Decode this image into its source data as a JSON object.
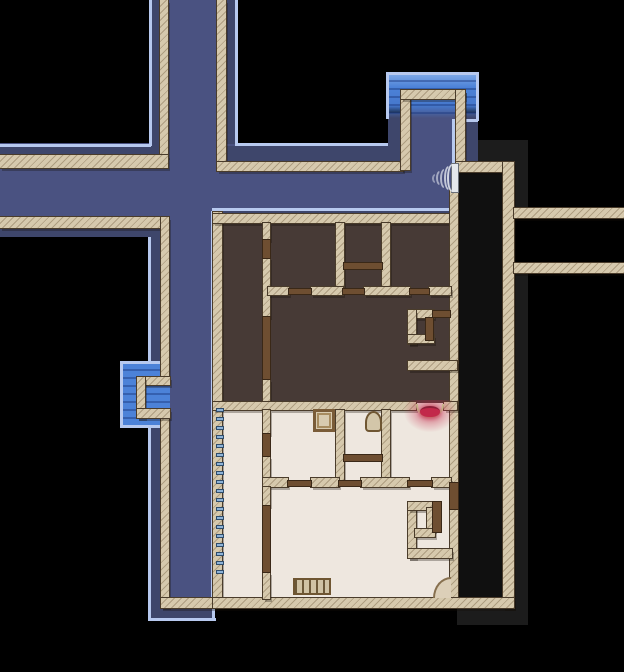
{
  "app": {
    "name": "top-down-map-view",
    "view": "explored floor plan with streets, water and building interior"
  },
  "canvas": {
    "w": 624,
    "h": 672
  },
  "palette": {
    "street": "#4a5281",
    "street_shadow": "#3e466b",
    "visibility_line": "#b7c9ef",
    "water": "#4c82d8",
    "wall": "#d6c9ad",
    "wall_hatch": "rgba(140,122,92,0.55)",
    "wall_edge": "#4a3c2b",
    "door_wood": "#6e4e31",
    "dark_room_floor": "#473a36",
    "light_room_floor": "#eee7df",
    "fog_gray": "#1c1c1c",
    "void_room": "#101010",
    "alert_red": "#c2294a",
    "window_tick": "#8db3d8"
  },
  "layers": [
    {
      "name": "fog-gray-patch",
      "cls": "g",
      "items": [
        [
          478,
          140,
          50,
          22
        ],
        [
          514,
          162,
          14,
          46
        ],
        [
          514,
          273,
          14,
          334
        ],
        [
          457,
          607,
          71,
          18
        ]
      ]
    },
    {
      "name": "unlit-room",
      "cls": "vd",
      "items": [
        [
          458,
          170,
          45,
          429
        ]
      ]
    },
    {
      "name": "street-floor",
      "cls": "st",
      "items": [
        [
          149,
          0,
          88,
          170
        ],
        [
          0,
          143,
          457,
          94
        ],
        [
          148,
          237,
          66,
          384
        ],
        [
          401,
          88,
          64,
          82
        ]
      ]
    },
    {
      "name": "street-shadow",
      "cls": "sh",
      "items": [
        [
          151,
          0,
          9,
          148
        ],
        [
          226,
          0,
          9,
          144
        ],
        [
          0,
          146,
          160,
          9
        ],
        [
          0,
          228,
          163,
          9
        ],
        [
          226,
          146,
          175,
          16
        ],
        [
          214,
          210,
          243,
          7
        ],
        [
          150,
          237,
          10,
          125
        ],
        [
          150,
          427,
          10,
          180
        ],
        [
          150,
          607,
          63,
          13
        ],
        [
          388,
          113,
          13,
          49
        ],
        [
          465,
          113,
          13,
          49
        ]
      ]
    },
    {
      "name": "water-pool",
      "cls": "wa",
      "items": [
        [
          386,
          74,
          92,
          44
        ]
      ]
    },
    {
      "name": "water-pool-side",
      "cls": "wa2",
      "items": [
        [
          122,
          363,
          48,
          63
        ]
      ]
    },
    {
      "name": "dark-room-floor",
      "cls": "fd",
      "items": [
        [
          221,
          222,
          230,
          181
        ]
      ]
    },
    {
      "name": "light-room-floor",
      "cls": "fl",
      "items": [
        [
          221,
          403,
          230,
          196
        ]
      ]
    },
    {
      "name": "visibility-line",
      "cls": "ll",
      "items": [
        [
          149,
          0,
          3,
          146
        ],
        [
          0,
          144,
          151,
          3
        ],
        [
          235,
          0,
          3,
          144
        ],
        [
          235,
          143,
          153,
          3
        ],
        [
          212,
          208,
          242,
          3
        ],
        [
          211,
          211,
          3,
          396
        ],
        [
          148,
          237,
          3,
          126
        ],
        [
          148,
          427,
          3,
          194
        ],
        [
          148,
          618,
          68,
          3
        ],
        [
          212,
          607,
          3,
          14
        ],
        [
          386,
          72,
          93,
          3
        ],
        [
          386,
          72,
          3,
          47
        ],
        [
          476,
          72,
          3,
          49
        ],
        [
          452,
          119,
          26,
          3
        ],
        [
          452,
          121,
          3,
          47
        ],
        [
          120,
          361,
          3,
          67
        ],
        [
          120,
          361,
          44,
          3
        ],
        [
          120,
          425,
          44,
          3
        ]
      ]
    },
    {
      "name": "wall-segment",
      "cls": "w",
      "items": [
        [
          160,
          0,
          8,
          157
        ],
        [
          0,
          155,
          168,
          13
        ],
        [
          217,
          0,
          9,
          164
        ],
        [
          217,
          162,
          186,
          9
        ],
        [
          0,
          217,
          163,
          11
        ],
        [
          161,
          217,
          8,
          162
        ],
        [
          161,
          415,
          8,
          192
        ],
        [
          137,
          377,
          33,
          8
        ],
        [
          137,
          377,
          8,
          41
        ],
        [
          137,
          409,
          33,
          9
        ],
        [
          161,
          598,
          56,
          10
        ],
        [
          401,
          90,
          9,
          80
        ],
        [
          401,
          90,
          64,
          9
        ],
        [
          456,
          90,
          9,
          74
        ],
        [
          456,
          162,
          48,
          10
        ],
        [
          503,
          162,
          11,
          446
        ],
        [
          514,
          208,
          110,
          10
        ],
        [
          514,
          263,
          110,
          10
        ],
        [
          213,
          212,
          9,
          395
        ],
        [
          213,
          214,
          245,
          9
        ],
        [
          450,
          190,
          8,
          293
        ],
        [
          450,
          509,
          8,
          90
        ],
        [
          213,
          598,
          301,
          10
        ],
        [
          263,
          223,
          7,
          17
        ],
        [
          263,
          257,
          7,
          60
        ],
        [
          263,
          379,
          7,
          24
        ],
        [
          336,
          223,
          8,
          66
        ],
        [
          382,
          223,
          8,
          66
        ],
        [
          268,
          287,
          21,
          8
        ],
        [
          311,
          287,
          32,
          8
        ],
        [
          364,
          287,
          46,
          8
        ],
        [
          429,
          287,
          22,
          8
        ],
        [
          408,
          310,
          26,
          8
        ],
        [
          408,
          310,
          8,
          34
        ],
        [
          408,
          335,
          26,
          8
        ],
        [
          408,
          361,
          49,
          9
        ],
        [
          213,
          402,
          203,
          8
        ],
        [
          444,
          402,
          13,
          8
        ],
        [
          263,
          410,
          7,
          24
        ],
        [
          263,
          456,
          7,
          31
        ],
        [
          336,
          410,
          8,
          73
        ],
        [
          382,
          410,
          8,
          73
        ],
        [
          263,
          478,
          25,
          9
        ],
        [
          311,
          478,
          28,
          9
        ],
        [
          361,
          478,
          48,
          9
        ],
        [
          432,
          478,
          19,
          9
        ],
        [
          263,
          487,
          7,
          19
        ],
        [
          263,
          572,
          7,
          27
        ],
        [
          408,
          502,
          8,
          56
        ],
        [
          408,
          502,
          26,
          8
        ],
        [
          427,
          508,
          8,
          23
        ],
        [
          415,
          529,
          20,
          8
        ],
        [
          408,
          549,
          44,
          9
        ]
      ]
    },
    {
      "name": "door-wood",
      "cls": "dr",
      "items": [
        [
          263,
          240,
          7,
          18
        ],
        [
          263,
          317,
          7,
          62
        ],
        [
          344,
          263,
          38,
          6
        ],
        [
          289,
          289,
          22,
          5
        ],
        [
          343,
          289,
          21,
          5
        ],
        [
          410,
          289,
          19,
          5
        ],
        [
          433,
          311,
          17,
          6
        ],
        [
          426,
          318,
          7,
          22
        ],
        [
          263,
          434,
          7,
          22
        ],
        [
          344,
          455,
          38,
          6
        ],
        [
          288,
          481,
          23,
          5
        ],
        [
          339,
          481,
          22,
          5
        ],
        [
          408,
          481,
          24,
          5
        ],
        [
          450,
          483,
          8,
          26
        ],
        [
          263,
          506,
          7,
          66
        ],
        [
          433,
          502,
          8,
          30
        ]
      ]
    },
    {
      "name": "window-tick",
      "cls": "tk",
      "items": [
        [
          216,
          408,
          8,
          4
        ],
        [
          216,
          417,
          8,
          4
        ],
        [
          216,
          426,
          8,
          4
        ],
        [
          216,
          435,
          8,
          4
        ],
        [
          216,
          444,
          8,
          4
        ],
        [
          216,
          453,
          8,
          4
        ],
        [
          216,
          462,
          8,
          4
        ],
        [
          216,
          471,
          8,
          4
        ],
        [
          216,
          480,
          8,
          4
        ],
        [
          216,
          489,
          8,
          4
        ],
        [
          216,
          498,
          8,
          4
        ],
        [
          216,
          507,
          8,
          4
        ],
        [
          216,
          516,
          8,
          4
        ],
        [
          216,
          525,
          8,
          4
        ],
        [
          216,
          534,
          8,
          4
        ],
        [
          216,
          543,
          8,
          4
        ],
        [
          216,
          552,
          8,
          4
        ],
        [
          216,
          561,
          8,
          4
        ],
        [
          216,
          570,
          8,
          4
        ]
      ]
    }
  ],
  "features": [
    {
      "cls": "crate",
      "name": "crate-object",
      "x": 313,
      "y": 409,
      "w": 22,
      "h": 23
    },
    {
      "cls": "urn",
      "name": "urn-object",
      "x": 365,
      "y": 411,
      "w": 17,
      "h": 21
    },
    {
      "cls": "bench",
      "name": "bench-object",
      "x": 293,
      "y": 578,
      "w": 38,
      "h": 17
    },
    {
      "cls": "qarc",
      "name": "door-swing-arc",
      "x": 433,
      "y": 577,
      "w": 18,
      "h": 21
    },
    {
      "cls": "wdoor",
      "name": "street-door-white",
      "x": 452,
      "y": 164,
      "w": 6,
      "h": 28
    },
    {
      "cls": "rglow",
      "name": "red-alert-glow",
      "x": 404,
      "y": 400,
      "w": 52,
      "h": 32
    },
    {
      "cls": "harc",
      "name": "red-door-swing-arc",
      "x": 416,
      "y": 404,
      "w": 28,
      "h": 14
    },
    {
      "cls": "rpool",
      "name": "red-alert-marker",
      "x": 420,
      "y": 406,
      "w": 20,
      "h": 11
    },
    {
      "cls": "snd",
      "name": "noise-wave-icon",
      "x": 432,
      "y": 174,
      "w": 6,
      "h": 9,
      "o": 0.5
    },
    {
      "cls": "snd",
      "name": "noise-wave-icon",
      "x": 436,
      "y": 171,
      "w": 7,
      "h": 14,
      "o": 0.62
    },
    {
      "cls": "snd",
      "name": "noise-wave-icon",
      "x": 440,
      "y": 169,
      "w": 8,
      "h": 19,
      "o": 0.72
    },
    {
      "cls": "snd",
      "name": "noise-wave-icon",
      "x": 444,
      "y": 166,
      "w": 9,
      "h": 24,
      "o": 0.82
    },
    {
      "cls": "snd",
      "name": "noise-wave-icon",
      "x": 447,
      "y": 164,
      "w": 10,
      "h": 28,
      "o": 0.92
    }
  ]
}
